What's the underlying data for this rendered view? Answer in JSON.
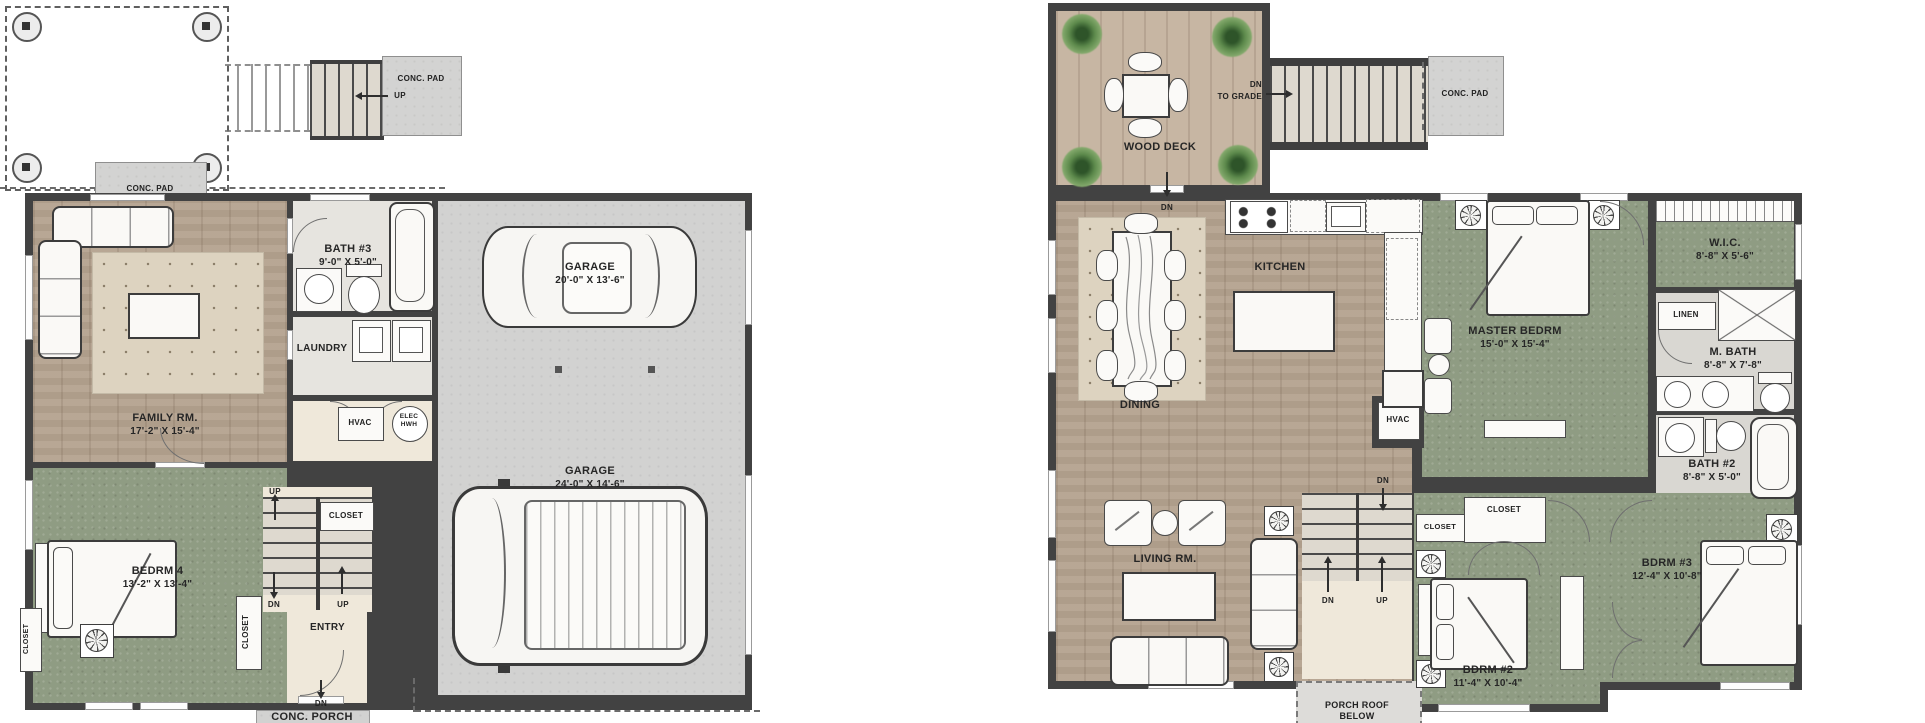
{
  "labels": {
    "up": "UP",
    "dn": "DN",
    "closet": "CLOSET",
    "conc_pad": "CONC. PAD",
    "conc_porch": "CONC. PORCH",
    "hvac": "HVAC",
    "linen": "LINEN",
    "elec_1": "ELEC",
    "elec_2": "HWH",
    "dn_to_grade_1": "DN",
    "dn_to_grade_2": "TO GRADE",
    "porch_roof_1": "PORCH ROOF",
    "porch_roof_2": "BELOW"
  },
  "lower": {
    "family": {
      "name": "FAMILY RM.",
      "dims": "17'-2\" X 15'-4\""
    },
    "bath3": {
      "name": "BATH #3",
      "dims": "9'-0\" X 5'-0\""
    },
    "laundry": {
      "name": "LAUNDRY"
    },
    "garage1": {
      "name": "GARAGE",
      "dims": "20'-0\" X 13'-6\""
    },
    "garage2": {
      "name": "GARAGE",
      "dims": "24'-0\" X 14'-6\""
    },
    "bedrm4": {
      "name": "BEDRM 4",
      "dims": "13'-2\" X 13'-4\""
    },
    "entry": {
      "name": "ENTRY"
    }
  },
  "upper": {
    "wood_deck": {
      "name": "WOOD DECK"
    },
    "kitchen": {
      "name": "KITCHEN"
    },
    "dining": {
      "name": "DINING"
    },
    "living": {
      "name": "LIVING RM."
    },
    "master": {
      "name": "MASTER BEDRM",
      "dims": "15'-0\" X 15'-4\""
    },
    "wic": {
      "name": "W.I.C.",
      "dims": "8'-8\" X 5'-6\""
    },
    "mbath": {
      "name": "M. BATH",
      "dims": "8'-8\" X 7'-8\""
    },
    "bath2": {
      "name": "BATH #2",
      "dims": "8'-8\" X 5'-0\""
    },
    "bdrm2": {
      "name": "BDRM #2",
      "dims": "11'-4\" X 10'-4\""
    },
    "bdrm3": {
      "name": "BDRM #3",
      "dims": "12'-4\" X 10'-8\""
    }
  },
  "colors": {
    "wall": "#424242",
    "wood_floor": "#b4a28e",
    "deck_wood": "#c7b6a3",
    "bedroom_green": "#8f9c83",
    "concrete": "#d2d2d1",
    "rug": "#ddd3c0",
    "entry_cream": "#efe8da"
  }
}
